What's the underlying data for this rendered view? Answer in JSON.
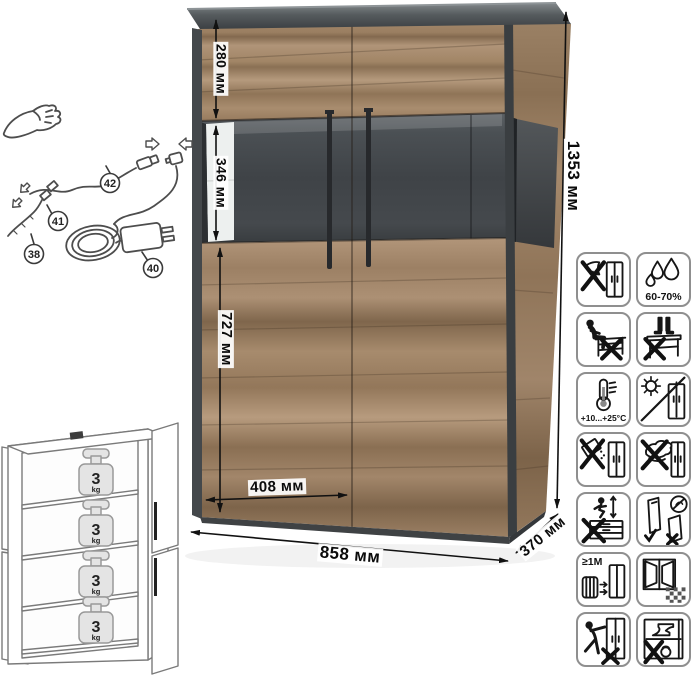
{
  "sheet": {
    "description": "display cabinet specification diagram"
  },
  "dimensions": {
    "unit": "мм",
    "top_section_height": "280 мм",
    "glass_section_height": "346 мм",
    "bottom_section_height": "727 мм",
    "door_width": "408 мм",
    "total_width": "858 мм",
    "depth": "370 мм",
    "total_height": "1353 мм"
  },
  "wiring_diagram": {
    "description": "LED lighting kit connection sketch",
    "parts": [
      {
        "number": "38",
        "name": "led-strip"
      },
      {
        "number": "40",
        "name": "power-adapter"
      },
      {
        "number": "41",
        "name": "strip-connector"
      },
      {
        "number": "42",
        "name": "lead-cable"
      }
    ]
  },
  "shelf_load_diagram": {
    "description": "maximum load per shelf",
    "shelves": [
      {
        "value": "3",
        "unit": "kg"
      },
      {
        "value": "3",
        "unit": "kg"
      },
      {
        "value": "3",
        "unit": "kg"
      },
      {
        "value": "3",
        "unit": "kg"
      }
    ]
  },
  "care_icons": [
    {
      "name": "no-sharp-tools",
      "label": ""
    },
    {
      "name": "humidity-range",
      "label": "60-70%"
    },
    {
      "name": "no-sitting",
      "label": ""
    },
    {
      "name": "no-standing",
      "label": ""
    },
    {
      "name": "temperature-range",
      "label": "+10...+25°C"
    },
    {
      "name": "no-direct-sunlight",
      "label": ""
    },
    {
      "name": "no-spilling",
      "label": ""
    },
    {
      "name": "no-abrasive-cleaning",
      "label": ""
    },
    {
      "name": "no-jumping",
      "label": ""
    },
    {
      "name": "carry-upright",
      "label": ""
    },
    {
      "name": "keep-away-from-heat",
      "label": "≥1M"
    },
    {
      "name": "ventilate-room",
      "label": ""
    },
    {
      "name": "no-pushing",
      "label": ""
    },
    {
      "name": "no-heavy-items-inside",
      "label": ""
    }
  ],
  "colors": {
    "wood_light": "#b59a7d",
    "wood_dark": "#83694f",
    "graphite": "#45484b",
    "arrow": "#111111",
    "icon_border": "#8f8f8f"
  }
}
